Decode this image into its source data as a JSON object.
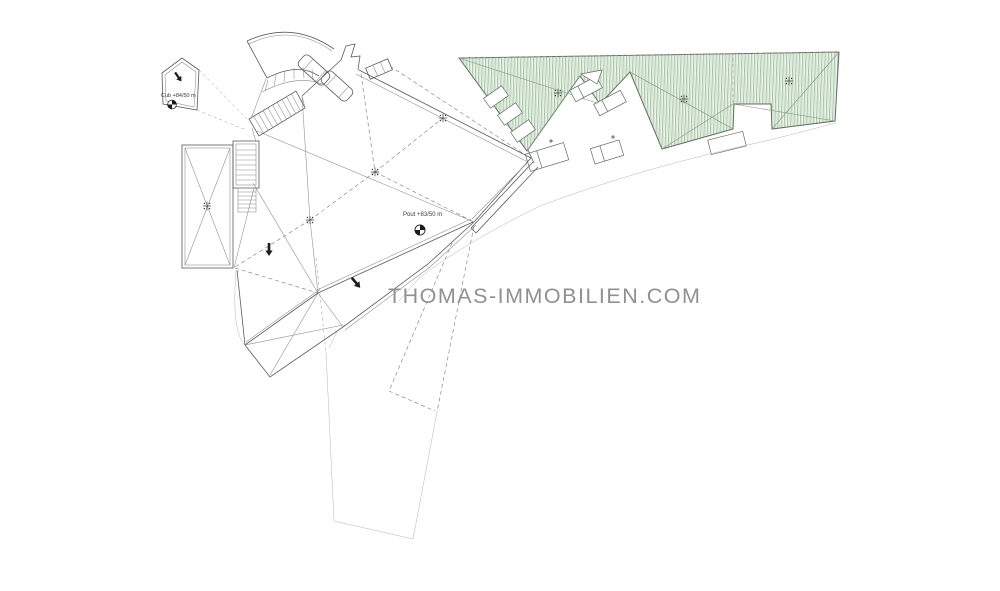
{
  "page": {
    "background": "#ffffff",
    "kind": "architectural roof plan drawing"
  },
  "watermark": {
    "text": "THOMAS-IMMOBILIEN.COM",
    "color": "#909090"
  },
  "plan": {
    "labels": {
      "cub_annotation": "Cub +84/50 m",
      "pout_annotation": "Pout +83/50 m"
    },
    "colors": {
      "line": "#5a5a5a",
      "line_light": "#9a9a9a",
      "hatch_green": "#9dbd9b",
      "hatch_background": "#f0f6ef",
      "terrace_border": "#5f6f5f",
      "symbol_black": "#1c1c1c"
    },
    "symbols": {
      "benchmark": "benchmark-icon (quartered circle level marker)",
      "survey_cross": "survey-cross-icon (plus marker with ticks)",
      "slope_arrow": "slope-arrow-icon (filled direction arrow)"
    }
  }
}
